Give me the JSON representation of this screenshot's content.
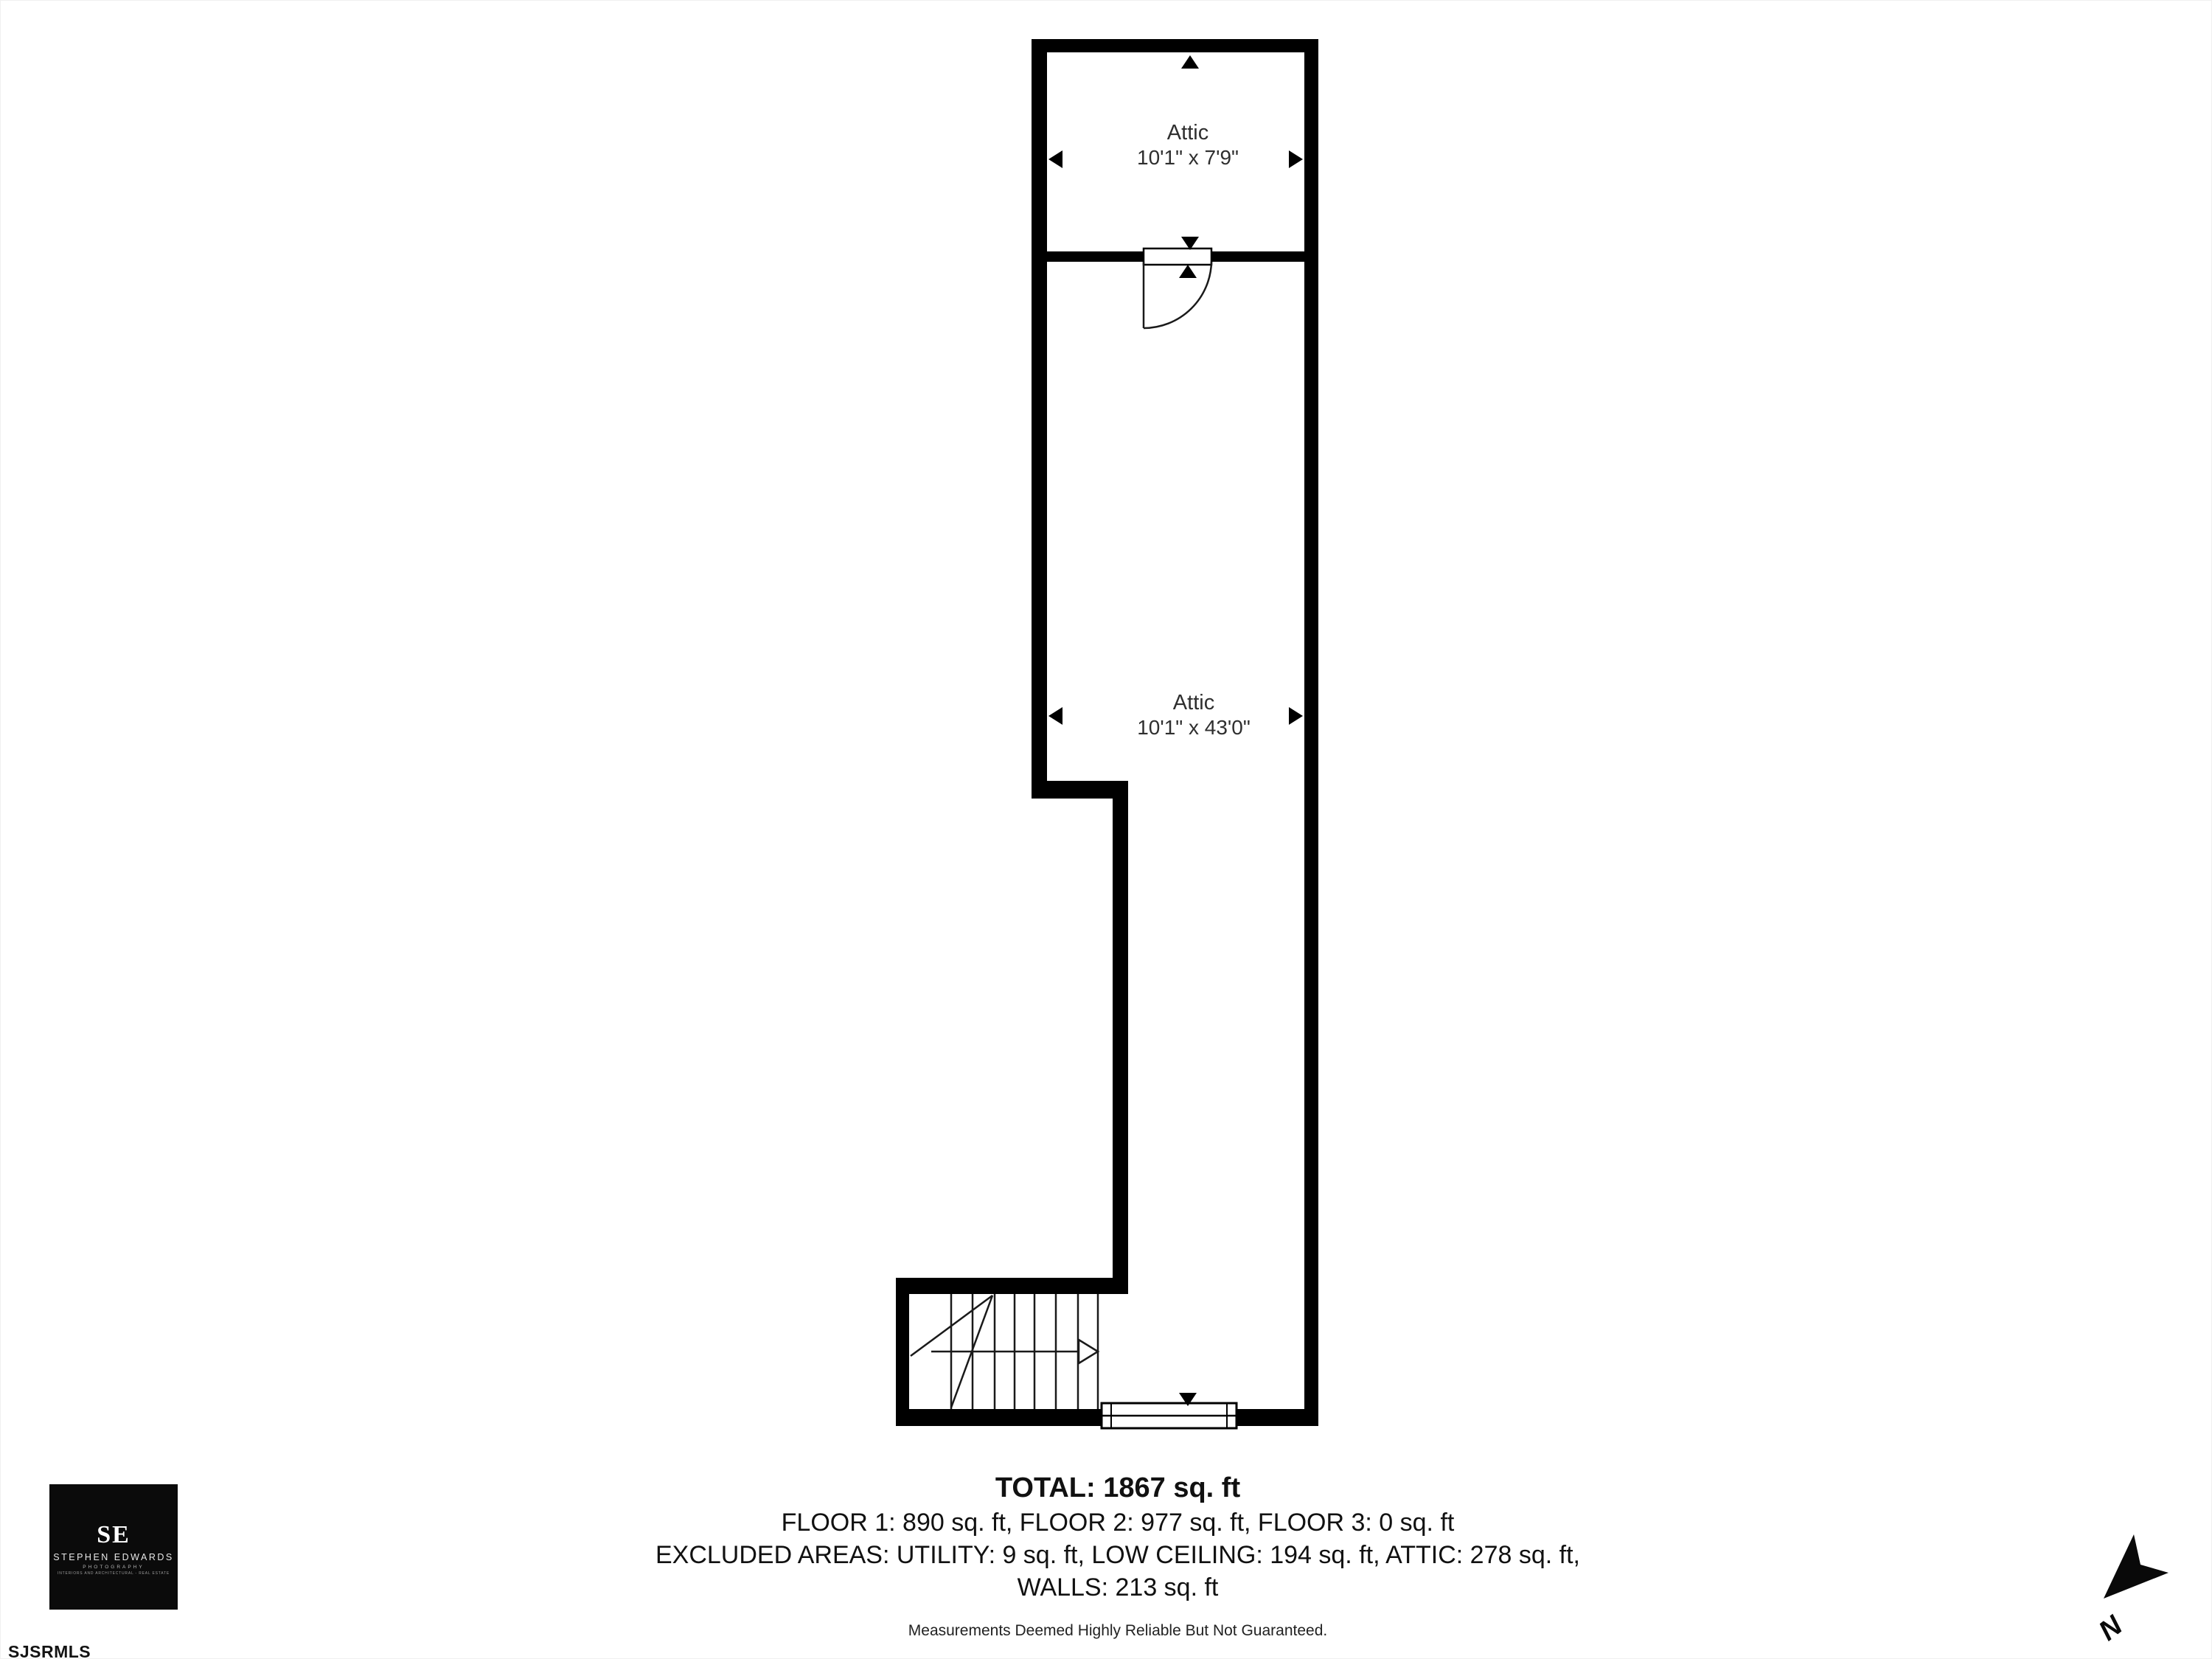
{
  "floor_plan": {
    "wall_color": "#000000",
    "rooms": [
      {
        "name": "Attic",
        "dimensions": "10'1\" x 7'9\""
      },
      {
        "name": "Attic",
        "dimensions": "10'1\" x 43'0\""
      }
    ]
  },
  "summary": {
    "total": "TOTAL: 1867 sq. ft",
    "floors": "FLOOR 1: 890 sq. ft, FLOOR 2: 977 sq. ft, FLOOR 3: 0 sq. ft",
    "excluded_areas": "EXCLUDED AREAS: UTILITY: 9 sq. ft, LOW CEILING: 194 sq. ft, ATTIC: 278 sq. ft,",
    "walls": "WALLS: 213 sq. ft",
    "disclaimer": "Measurements Deemed Highly Reliable But Not Guaranteed."
  },
  "logo": {
    "monogram": "SE",
    "name": "STEPHEN EDWARDS",
    "subtitle": "PHOTOGRAPHY",
    "tagline": "INTERIORS AND ARCHITECTURAL - REAL ESTATE"
  },
  "compass": {
    "north_label": "N"
  },
  "mls_watermark": "SJSRMLS"
}
